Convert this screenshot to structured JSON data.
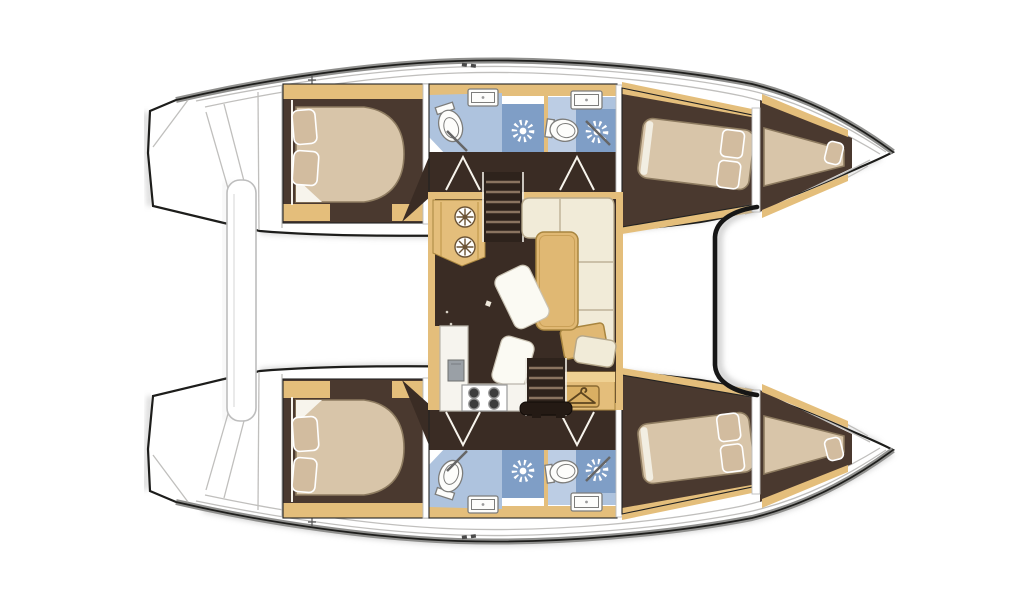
{
  "meta": {
    "title": "Catamaran yacht interior layout floor plan (top view)",
    "view": "top-down deck plan",
    "text_labels": []
  },
  "palette": {
    "deck": "#ffffff",
    "outline": "#1d1d1b",
    "gunwale": "#8f8f8d",
    "deckline": "#c0bfbd",
    "floor": "#4a392f",
    "floor_dark": "#3a2c24",
    "wood": "#e4be7b",
    "wood_dark": "#a8853f",
    "wood_light": "#efd193",
    "mattress": "#d8c5a9",
    "mattress_edge": "#8d7b60",
    "pillow": "#d2bc9f",
    "sheet": "#f7f4ec",
    "sofa": "#f1ebd8",
    "sofa_edge": "#b5a78a",
    "bath": "#aec3de",
    "bath_light": "#bccde4",
    "shower": "#7f9ec6",
    "fixture": "#fdfdfb",
    "fixture_edge": "#7d7d7b",
    "gray_fix": "#9aa0a6",
    "table": "#e0b873",
    "steps": "#2e231c",
    "tread": "#8a7460",
    "rail": "#efece4",
    "paper": "#fbfaf3",
    "shadow": "#a3a3a3",
    "plaque": "#d9af63",
    "plaque_edge": "#8a6a33",
    "burner": "#3c3c3c"
  },
  "icons": [
    {
      "name": "shower-drain-icon",
      "shape": "sunburst",
      "count": 4
    },
    {
      "name": "clothes-hanger-icon",
      "shape": "hanger plaque",
      "count": 1
    },
    {
      "name": "stove-burner-icon",
      "shape": "4 dark circles",
      "count": 1
    },
    {
      "name": "stool-rosette-icon",
      "shape": "spoked circle",
      "count": 2
    }
  ],
  "structure": {
    "hulls": [
      "port-hull (top)",
      "starboard-hull (bottom, mirrored)"
    ],
    "per_hull_rooms": [
      "aft-cabin double berth",
      "bathroom-aft with shower",
      "bathroom-forward with shower",
      "corridor",
      "forward-cabin double berth",
      "forepeak berth"
    ],
    "bridgedeck": [
      "saloon",
      "nav-console",
      "l-sofa",
      "table",
      "galley with stove and sink",
      "wardrobe",
      "companionway-stairs x2"
    ],
    "exterior": [
      "transom steps x2",
      "aft platform bar",
      "forward crossbeam bracket"
    ]
  }
}
